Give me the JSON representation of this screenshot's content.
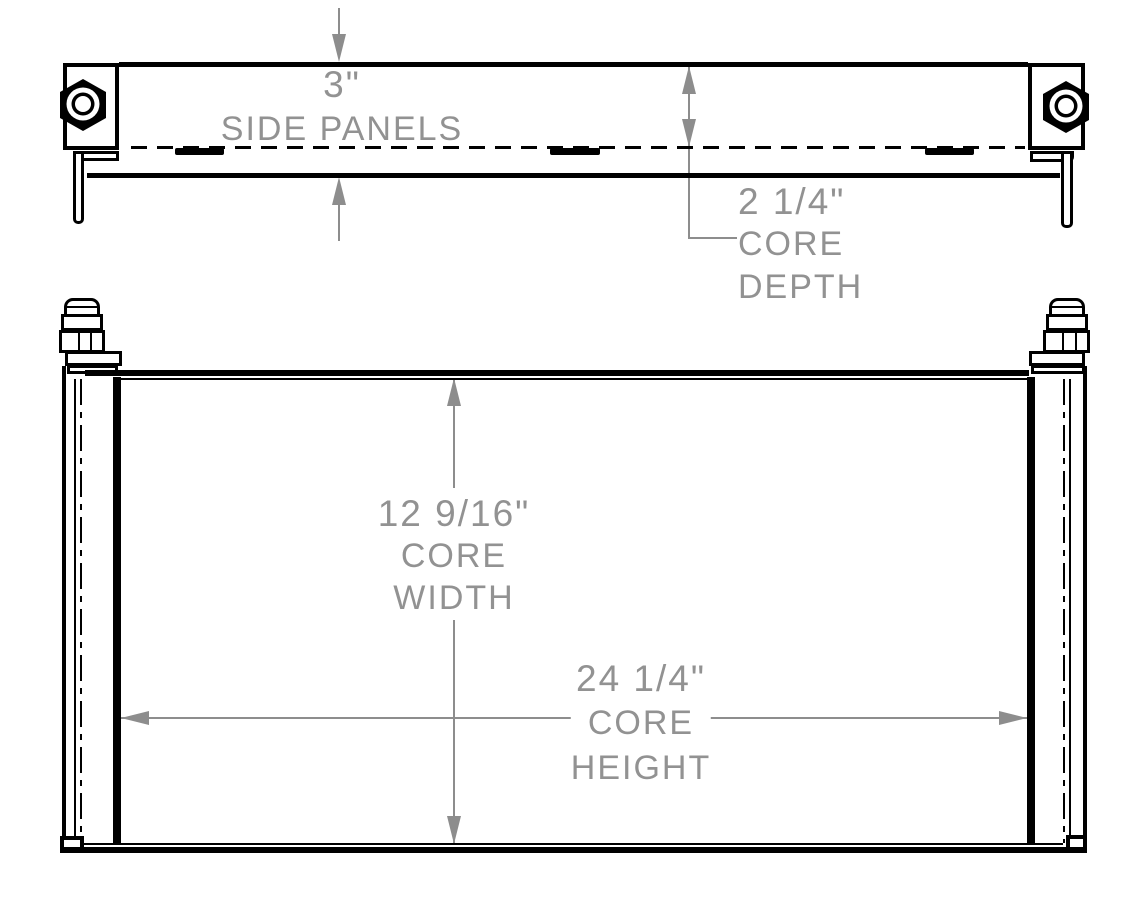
{
  "annotations": {
    "side_panels": {
      "value": "3\"",
      "label": "SIDE PANELS"
    },
    "core_depth": {
      "value": "2 1/4\"",
      "word1": "CORE",
      "word2": "DEPTH"
    },
    "core_width": {
      "value": "12 9/16\"",
      "word1": "CORE",
      "word2": "WIDTH"
    },
    "core_height": {
      "value": "24 1/4\"",
      "word1": "CORE",
      "word2": "HEIGHT"
    }
  },
  "colors": {
    "ink": "#000000",
    "dimension_gray": "#8d8d8d",
    "text_gray": "#929292",
    "background": "#ffffff"
  }
}
